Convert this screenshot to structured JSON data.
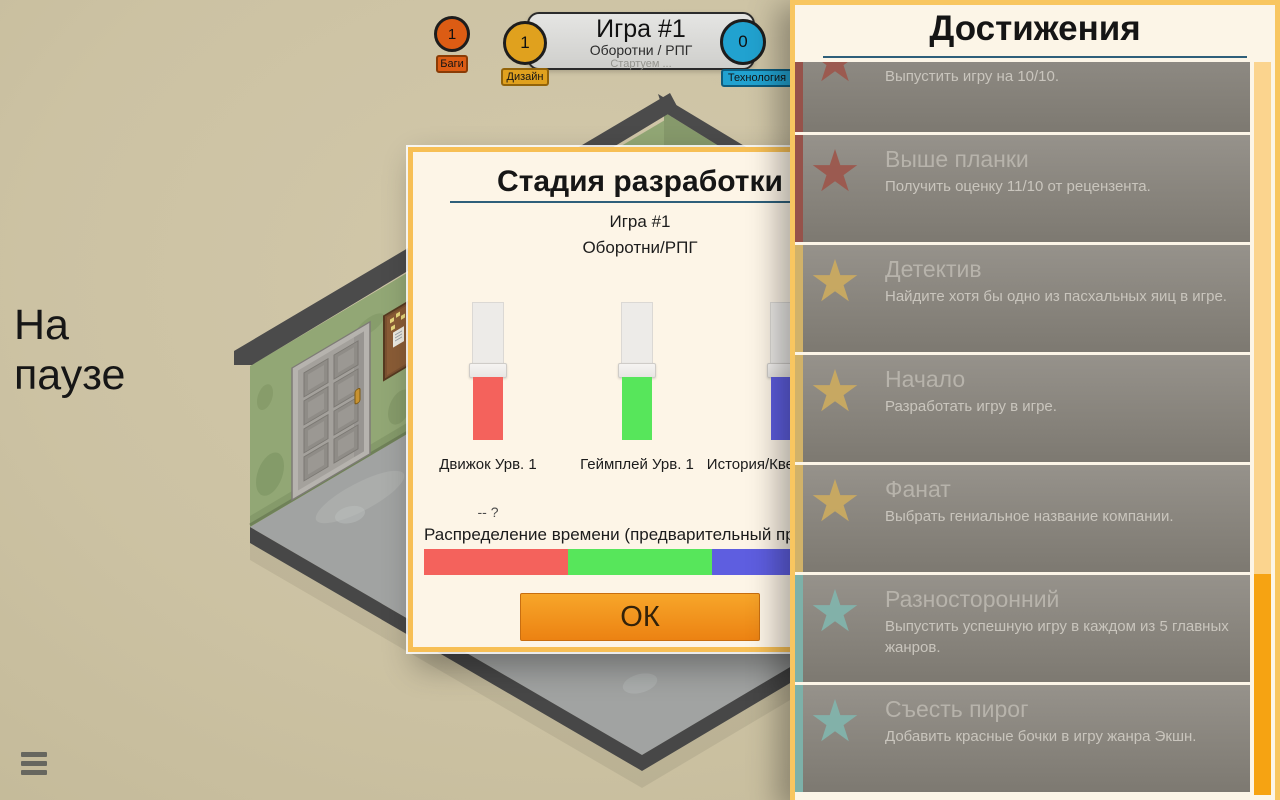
{
  "theme": {
    "underline_accent": "#2e5f7a",
    "dialog_border": "#f7bf55",
    "panel_border": "#f8c660"
  },
  "pause_overlay": {
    "text": "На паузе"
  },
  "top_bar": {
    "title": "Игра #1",
    "subtitle": "Оборотни / РПГ",
    "status": "Стартуем ...",
    "counters": [
      {
        "value": "1",
        "label": "Баги",
        "color": "#dc5c14",
        "border": "#8a3c06"
      },
      {
        "value": "1",
        "label": "Дизайн",
        "color": "#e0a11e",
        "border": "#93640a"
      },
      {
        "value": "0",
        "label": "Технология",
        "color": "#21a2d0",
        "border": "#0e5d7e"
      }
    ]
  },
  "dev_dialog": {
    "title": "Стадия разработки",
    "game_name": "Игра #1",
    "game_genre": "Оборотни/РПГ",
    "sliders": [
      {
        "label": "Движок Урв. 1",
        "color": "#f4625c"
      },
      {
        "label": "Геймплей Урв. 1",
        "color": "#57e65b"
      },
      {
        "label": "История/Квесты Урв. 1",
        "color": "#5e5ee0"
      }
    ],
    "hint": "-- ?",
    "allocation_label": "Распределение времени (предварительный просмотр)",
    "ok_label": "ОК"
  },
  "achievements": {
    "title": "Достижения",
    "star_glyph": "★",
    "items": [
      {
        "name": "",
        "description": "Выпустить игру на 10/10.",
        "tier_color": "#9d574c",
        "strip_color": "#96524a"
      },
      {
        "name": "Выше планки",
        "description": "Получить оценку 11/10 от рецензента.",
        "tier_color": "#9d574c",
        "strip_color": "#96524a"
      },
      {
        "name": "Детектив",
        "description": "Найдите хотя бы одно из пасхальных яиц в игре.",
        "tier_color": "#ccab60",
        "strip_color": "#d1b269"
      },
      {
        "name": "Начало",
        "description": "Разработать игру в игре.",
        "tier_color": "#ccab60",
        "strip_color": "#d1b269"
      },
      {
        "name": "Фанат",
        "description": "Выбрать гениальное название компании.",
        "tier_color": "#ccab60",
        "strip_color": "#d1b269"
      },
      {
        "name": "Разносторонний",
        "description": "Выпустить успешную игру в каждом из 5 главных жанров.",
        "tier_color": "#82b5ad",
        "strip_color": "#7db1a9"
      },
      {
        "name": "Съесть пирог",
        "description": "Добавить красные бочки в игру жанра Экшн.",
        "tier_color": "#82b5ad",
        "strip_color": "#7db1a9"
      }
    ],
    "scrollbar": {
      "track_color": "#fbd48e",
      "thumb_color": "#f6a312"
    }
  }
}
